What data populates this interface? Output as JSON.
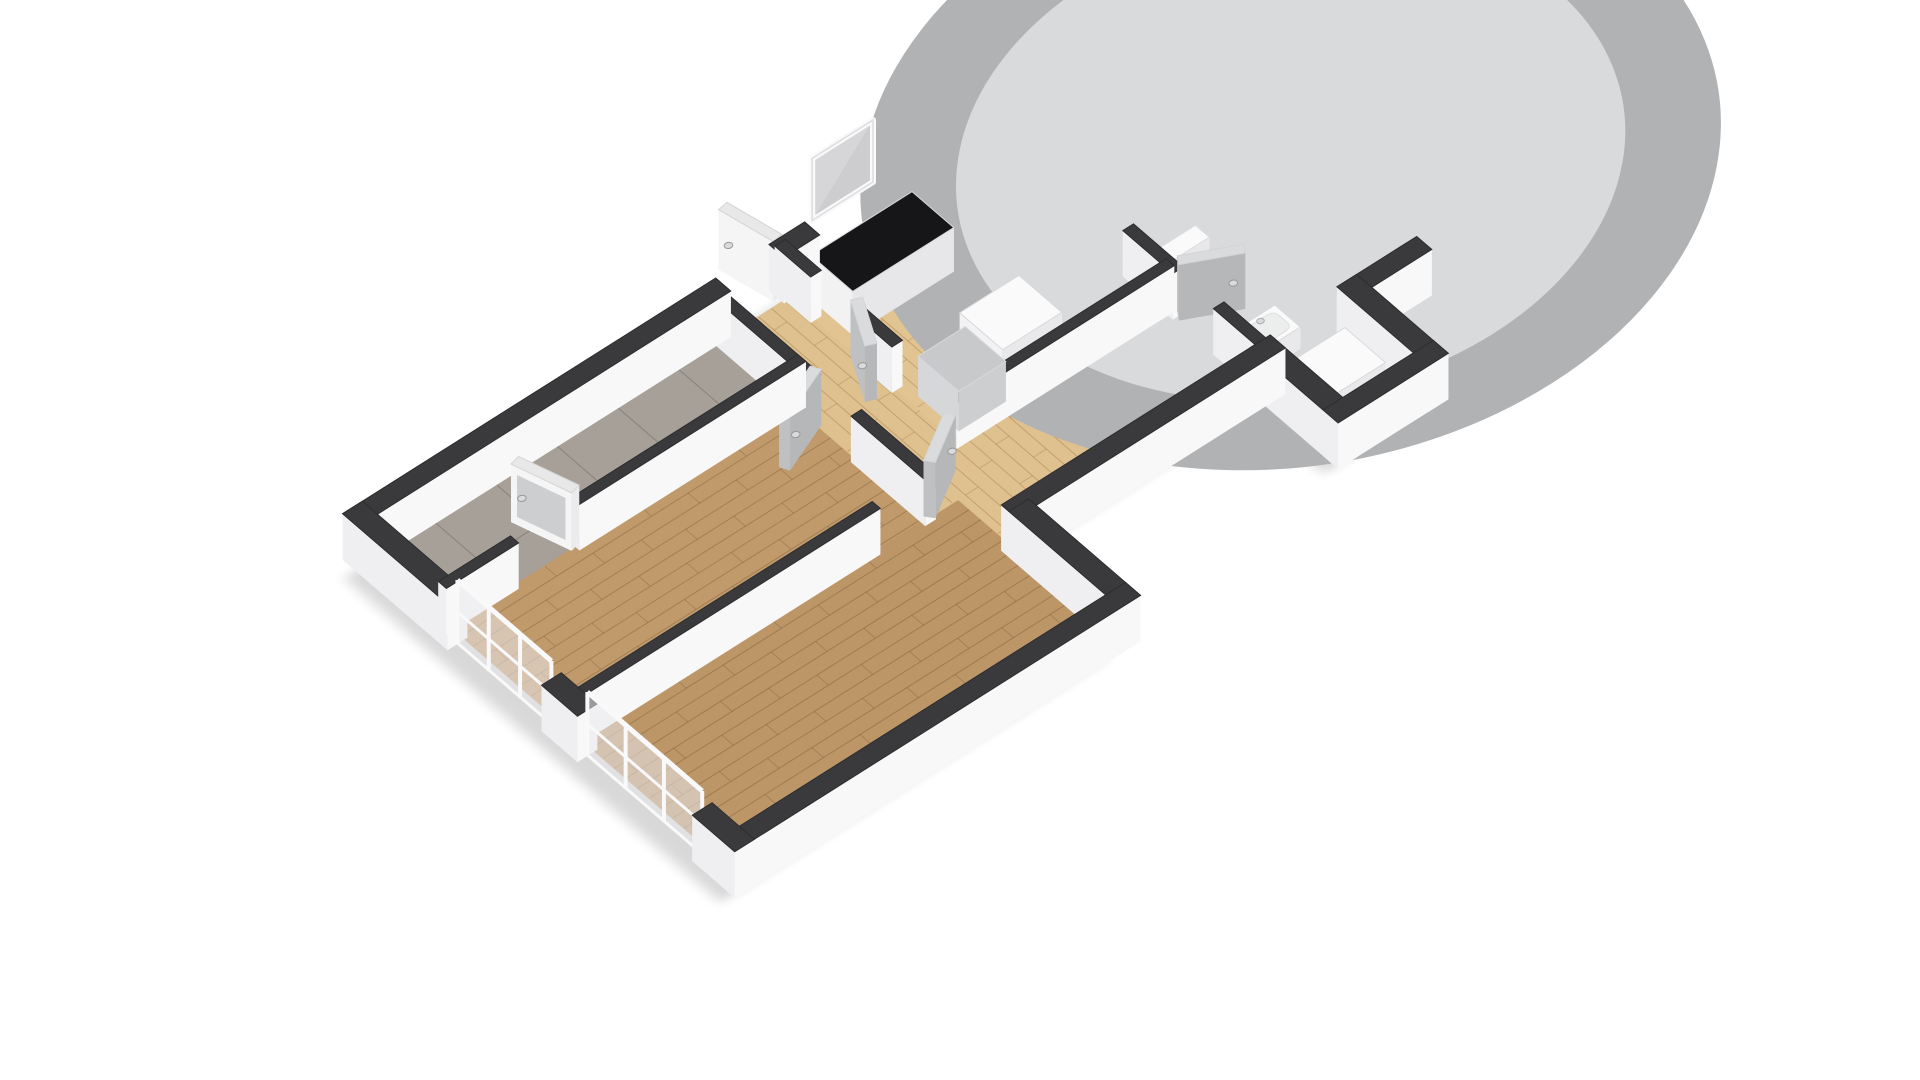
{
  "canvas": {
    "width": 1920,
    "height": 1080,
    "background": "#ffffff"
  },
  "projection": {
    "matrix": [
      76,
      -48,
      58,
      50,
      360,
      560
    ],
    "lift": [
      0.00881,
      -0.011544
    ],
    "wall_height_px": 46
  },
  "palette": {
    "background": "#ffffff",
    "wall_top": "#3a3a3c",
    "wall_top_stroke": "#2d2d2f",
    "wall_side_ew": "#efeff1",
    "wall_side_ns": "#f8f8f9",
    "shadow": "#000000",
    "wood_dark": "#c19a6c",
    "wood_dark_seam": "rgba(120,90,55,0.42)",
    "wood_light": "#dfc08f",
    "wood_light_seam": "rgba(160,124,74,0.45)",
    "tile_gray": "#a7a098",
    "tile_gray_seam": "rgba(60,55,50,0.28)",
    "tile_beige": "#d7cbb5",
    "tile_beige_seam": "rgba(120,110,90,0.32)",
    "door_gray_face": "#bfc0c2",
    "door_gray_face2": "#b6b7b9",
    "door_gray_top": "#dadbdc",
    "door_white_face": "#f5f5f6",
    "door_white_face2": "#ebebed",
    "door_white_top": "#e8e8e9",
    "glass": "#c9cacc",
    "glass_pale": "#d6d6d8",
    "frame_white": "#f9f9fa",
    "steel": "#ccd0d2",
    "steel_dark": "#9ba1a5",
    "cooktop_black": "#1e1f21",
    "burner_ring": "#595b5e",
    "towel_plum": "#38122c",
    "fixture_white": "#fafafb"
  },
  "floors": [
    {
      "name": "floor-balcony-west",
      "poly": [
        [
          0.1,
          0.1
        ],
        [
          4.66,
          0.1
        ],
        [
          4.66,
          1.42
        ],
        [
          0.1,
          1.42
        ]
      ],
      "fill": "#a7a098",
      "pattern": "tile",
      "spacing": 0.8,
      "seam": "rgba(60,55,50,0.28)"
    },
    {
      "name": "floor-living-room",
      "poly": [
        [
          0.1,
          1.42
        ],
        [
          4.66,
          1.42
        ],
        [
          4.66,
          3.66
        ],
        [
          0.1,
          3.66
        ]
      ],
      "fill": "#c19a6c",
      "pattern": "wood-ew",
      "spacing": 0.2,
      "seam": "rgba(120,90,55,0.42)"
    },
    {
      "name": "floor-bedroom",
      "poly": [
        [
          0.1,
          3.66
        ],
        [
          5.08,
          3.66
        ],
        [
          5.08,
          6.4
        ],
        [
          0.1,
          6.4
        ]
      ],
      "fill": "#bd9668",
      "pattern": "wood-ew",
      "spacing": 0.2,
      "seam": "rgba(115,86,52,0.42)"
    },
    {
      "name": "floor-hallway",
      "poly": [
        [
          4.66,
          0.1
        ],
        [
          5.58,
          0.1
        ],
        [
          5.58,
          3.0
        ],
        [
          8.36,
          3.0
        ],
        [
          8.36,
          4.6
        ],
        [
          5.08,
          4.6
        ],
        [
          5.08,
          3.66
        ],
        [
          4.66,
          3.66
        ]
      ],
      "fill": "#dfc08f",
      "pattern": "wood-ns",
      "spacing": 0.17,
      "seam": "rgba(160,124,74,0.45)"
    },
    {
      "name": "floor-kitchen",
      "poly": [
        [
          5.58,
          0.1
        ],
        [
          8.3,
          0.1
        ],
        [
          8.3,
          3.0
        ],
        [
          5.58,
          3.0
        ]
      ],
      "fill": "#e2c492",
      "pattern": "wood-ns",
      "spacing": 0.17,
      "seam": "rgba(160,124,74,0.45)"
    },
    {
      "name": "floor-balcony-east",
      "poly": [
        [
          8.3,
          0.1
        ],
        [
          9.36,
          0.1
        ],
        [
          9.36,
          2.36
        ],
        [
          8.3,
          2.36
        ]
      ],
      "fill": "#a39c94",
      "pattern": "tile",
      "spacing": 0.9,
      "seam": "rgba(60,55,50,0.28)"
    },
    {
      "name": "floor-bathroom",
      "poly": [
        [
          8.36,
          2.36
        ],
        [
          10.34,
          2.36
        ],
        [
          10.34,
          4.63
        ],
        [
          8.36,
          4.63
        ]
      ],
      "fill": "#d7cbb5",
      "pattern": "tile",
      "spacing": 0.62,
      "seam": "rgba(120,110,90,0.32)"
    },
    {
      "name": "floor-utility",
      "poly": [
        [
          8.36,
          4.63
        ],
        [
          9.55,
          4.63
        ],
        [
          9.55,
          5.95
        ],
        [
          8.36,
          5.95
        ]
      ],
      "fill": "#d5c9b3",
      "pattern": "tile",
      "spacing": 0.62,
      "seam": "rgba(120,110,90,0.32)"
    }
  ],
  "outline": [
    [
      0,
      0
    ],
    [
      9.36,
      0
    ],
    [
      9.36,
      2.36
    ],
    [
      10.34,
      2.36
    ],
    [
      10.34,
      4.63
    ],
    [
      9.55,
      4.63
    ],
    [
      9.55,
      5.95
    ],
    [
      8.36,
      5.95
    ],
    [
      8.36,
      4.7
    ],
    [
      5.08,
      4.7
    ],
    [
      5.08,
      6.5
    ],
    [
      0,
      6.5
    ]
  ],
  "shadow": {
    "offset": [
      -0.28,
      0.09
    ],
    "opacity": 0.15,
    "blur": 0.07
  },
  "walls": [
    {
      "name": "wall-north-balcony-west",
      "a": [
        -0.13,
        0
      ],
      "b": [
        4.78,
        0
      ],
      "t": 0.26,
      "h": 46
    },
    {
      "name": "wall-north-entry",
      "a": [
        5.48,
        0
      ],
      "b": [
        5.95,
        0
      ],
      "t": 0.26,
      "h": 46
    },
    {
      "name": "wall-north-kitchen",
      "a": [
        6.75,
        0
      ],
      "b": [
        9.49,
        0
      ],
      "t": 0.26,
      "h": 46
    },
    {
      "name": "wall-west-living",
      "a": [
        0,
        -0.13
      ],
      "b": [
        0,
        1.68
      ],
      "t": 0.26,
      "h": 46
    },
    {
      "name": "wall-west-mid",
      "a": [
        0,
        3.3
      ],
      "b": [
        0,
        3.92
      ],
      "t": 0.26,
      "h": 46
    },
    {
      "name": "wall-west-south",
      "a": [
        0,
        5.9
      ],
      "b": [
        0,
        6.63
      ],
      "t": 0.26,
      "h": 46
    },
    {
      "name": "wall-south-bedroom",
      "a": [
        -0.13,
        6.5
      ],
      "b": [
        5.21,
        6.5
      ],
      "t": 0.26,
      "h": 46
    },
    {
      "name": "wall-east-bedroom",
      "a": [
        5.08,
        6.63
      ],
      "b": [
        5.08,
        4.7
      ],
      "t": 0.26,
      "h": 46
    },
    {
      "name": "wall-south-corridor",
      "a": [
        4.95,
        4.7
      ],
      "b": [
        8.49,
        4.7
      ],
      "t": 0.26,
      "h": 46
    },
    {
      "name": "wall-west-utility",
      "a": [
        8.36,
        4.57
      ],
      "b": [
        8.36,
        6.08
      ],
      "t": 0.26,
      "h": 46
    },
    {
      "name": "wall-south-utility",
      "a": [
        8.23,
        5.95
      ],
      "b": [
        9.68,
        5.95
      ],
      "t": 0.26,
      "h": 46
    },
    {
      "name": "wall-east-utility",
      "a": [
        9.55,
        6.08
      ],
      "b": [
        9.55,
        4.5
      ],
      "t": 0.26,
      "h": 46
    },
    {
      "name": "wall-south-bathroom",
      "a": [
        9.42,
        4.63
      ],
      "b": [
        10.47,
        4.63
      ],
      "t": 0.26,
      "h": 46
    },
    {
      "name": "wall-east-bathroom",
      "a": [
        10.34,
        4.76
      ],
      "b": [
        10.34,
        2.23
      ],
      "t": 0.26,
      "h": 46
    },
    {
      "name": "wall-north-bathroom-east",
      "a": [
        10.12,
        2.36
      ],
      "b": [
        10.47,
        2.36
      ],
      "t": 0.26,
      "h": 46
    },
    {
      "name": "wall-parapet-balcony-east",
      "a": [
        9.36,
        -0.13
      ],
      "b": [
        9.36,
        2.49
      ],
      "t": 0.26,
      "h": 46
    },
    {
      "name": "wall-balcony-south-bath-north",
      "a": [
        8.23,
        2.36
      ],
      "b": [
        9.55,
        2.36
      ],
      "t": 0.22,
      "h": 46
    },
    {
      "name": "wall-divider-balcony-west-a",
      "a": [
        0,
        1.42
      ],
      "b": [
        0.95,
        1.42
      ],
      "t": 0.14,
      "h": 46
    },
    {
      "name": "wall-divider-balcony-west-b",
      "a": [
        1.75,
        1.42
      ],
      "b": [
        4.73,
        1.42
      ],
      "t": 0.14,
      "h": 46
    },
    {
      "name": "wall-hall-west-a",
      "a": [
        4.66,
        -0.07
      ],
      "b": [
        4.66,
        1.75
      ],
      "t": 0.14,
      "h": 46
    },
    {
      "name": "wall-hall-west-b",
      "a": [
        4.66,
        2.45
      ],
      "b": [
        4.66,
        3.73
      ],
      "t": 0.14,
      "h": 46
    },
    {
      "name": "wall-bedroom-north",
      "a": [
        -0.07,
        3.66
      ],
      "b": [
        4.0,
        3.66
      ],
      "t": 0.14,
      "h": 46
    },
    {
      "name": "wall-hall-east-a",
      "a": [
        5.58,
        -0.07
      ],
      "b": [
        5.58,
        0.55
      ],
      "t": 0.14,
      "h": 46
    },
    {
      "name": "wall-hall-east-b",
      "a": [
        5.58,
        1.25
      ],
      "b": [
        5.58,
        1.95
      ],
      "t": 0.14,
      "h": 46
    },
    {
      "name": "wall-kitchen-south",
      "a": [
        5.51,
        3.0
      ],
      "b": [
        8.37,
        3.0
      ],
      "t": 0.14,
      "h": 46
    },
    {
      "name": "wall-kitchen-balcony-a",
      "a": [
        8.3,
        -0.07
      ],
      "b": [
        8.3,
        0.5
      ],
      "t": 0.14,
      "h": 46
    },
    {
      "name": "wall-kitchen-balcony-b",
      "a": [
        8.3,
        1.2
      ],
      "b": [
        8.3,
        2.43
      ],
      "t": 0.14,
      "h": 46
    },
    {
      "name": "wall-bathroom-west-a",
      "a": [
        8.36,
        2.29
      ],
      "b": [
        8.36,
        3.15
      ],
      "t": 0.14,
      "h": 46
    },
    {
      "name": "wall-bathroom-west-b",
      "a": [
        8.36,
        3.85
      ],
      "b": [
        8.36,
        4.77
      ],
      "t": 0.14,
      "h": 46
    }
  ],
  "doors": [
    {
      "name": "entry-door",
      "hinge": [
        5.48,
        0.02
      ],
      "deg": -100,
      "len": 0.78,
      "style": "white",
      "h": 60
    },
    {
      "name": "balcony-west-door",
      "hinge": [
        1.75,
        1.42
      ],
      "deg": -105,
      "len": 0.8,
      "style": "glazed",
      "h": 58
    },
    {
      "name": "living-room-door",
      "hinge": [
        4.66,
        1.75
      ],
      "deg": 155,
      "len": 0.7,
      "style": "gray",
      "h": 56
    },
    {
      "name": "kitchen-hall-door",
      "hinge": [
        5.58,
        1.25
      ],
      "deg": 115,
      "len": 0.7,
      "style": "gray",
      "h": 56
    },
    {
      "name": "bedroom-door",
      "hinge": [
        4.7,
        3.66
      ],
      "deg": -35,
      "len": 0.7,
      "style": "gray",
      "h": 56
    },
    {
      "name": "kitchen-balcony-door",
      "hinge": [
        8.3,
        0.5
      ],
      "deg": 25,
      "len": 0.72,
      "style": "glazed",
      "h": 58
    },
    {
      "name": "bathroom-door",
      "hinge": [
        8.36,
        3.15
      ],
      "deg": 30,
      "len": 0.7,
      "style": "gray",
      "h": 56
    }
  ],
  "windows": [
    {
      "name": "french-window-living",
      "type": "french",
      "a": [
        0,
        1.68
      ],
      "b": [
        0,
        3.3
      ],
      "z0": 0,
      "z1": 64
    },
    {
      "name": "french-window-bedroom",
      "type": "french",
      "a": [
        0,
        3.92
      ],
      "b": [
        0,
        5.9
      ],
      "z0": 0,
      "z1": 64
    },
    {
      "name": "entry-window",
      "type": "floating",
      "a": [
        5.95,
        0
      ],
      "b": [
        6.75,
        0
      ],
      "z0": 54,
      "z1": 116
    },
    {
      "name": "bathroom-window",
      "type": "floating",
      "a": [
        9.55,
        2.36
      ],
      "b": [
        10.12,
        2.36
      ],
      "z0": 8,
      "z1": 44
    }
  ],
  "fixtures": [
    {
      "name": "wardrobe",
      "type": "box",
      "rect": [
        5.72,
        0.28,
        1.33,
        0.72
      ],
      "h": 44,
      "top": "#161618",
      "side": "#f2f2f3",
      "side2": "#e7e7e9"
    },
    {
      "name": "fridge",
      "type": "box",
      "rect": [
        6.38,
        1.98,
        0.78,
        0.74
      ],
      "h": 40,
      "top": "#fafafb",
      "side": "#f2f2f4",
      "side2": "#e9e9eb"
    },
    {
      "name": "kitchen-cabinet",
      "type": "box",
      "rect": [
        5.68,
        2.18,
        0.62,
        0.7
      ],
      "h": 40,
      "top": "#c7c9cb",
      "side": "#d6d7d9",
      "side2": "#cdced0"
    },
    {
      "name": "washing-machine",
      "type": "box",
      "rect": [
        8.52,
        4.82,
        0.76,
        0.7
      ],
      "h": 28,
      "top": "#fafafb",
      "side": "#f1f1f3",
      "side2": "#e9e9eb"
    },
    {
      "name": "kitchen-counter",
      "type": "counter",
      "rect": [
        7.76,
        0.42,
        0.5,
        1.88
      ],
      "h": 34,
      "top": "#b2b5b7",
      "side": "#cdcfd1",
      "side2": "#c3c5c7",
      "sink": {
        "plate": [
          7.79,
          1.2,
          0.44,
          0.9
        ],
        "basins": [
          [
            7.82,
            1.26,
            0.36,
            0.36
          ],
          [
            7.82,
            1.7,
            0.36,
            0.34
          ]
        ],
        "faucet": [
          8.18,
          1.64
        ]
      },
      "cooktop": {
        "rect": [
          7.79,
          0.48,
          0.44,
          0.62
        ],
        "burners": [
          [
            7.9,
            0.63,
            0.085
          ],
          [
            8.12,
            0.68,
            0.065
          ],
          [
            7.9,
            0.94,
            0.065
          ],
          [
            8.12,
            0.99,
            0.085
          ]
        ]
      }
    },
    {
      "name": "bathtub",
      "type": "tub",
      "rect": [
        9.56,
        2.48,
        0.74,
        2.04
      ],
      "h": 20,
      "inner": [
        9.64,
        2.58,
        0.58,
        1.84
      ],
      "towel": [
        9.56,
        3.5,
        0.74,
        0.42
      ],
      "towel_color": "#38122c",
      "shower": [
        10.2,
        2.68
      ]
    },
    {
      "name": "toilet",
      "type": "toilet",
      "tank": [
        8.54,
        2.48,
        0.56,
        0.24
      ],
      "h": 22,
      "bowl": [
        8.82,
        2.94,
        0.26,
        0.28
      ]
    },
    {
      "name": "washbasin",
      "type": "basin",
      "rect": [
        8.5,
        3.98,
        0.5,
        0.44
      ],
      "h": 22,
      "inner": [
        8.56,
        4.04,
        0.38,
        0.32
      ],
      "faucet": [
        8.75,
        4.06
      ]
    }
  ]
}
